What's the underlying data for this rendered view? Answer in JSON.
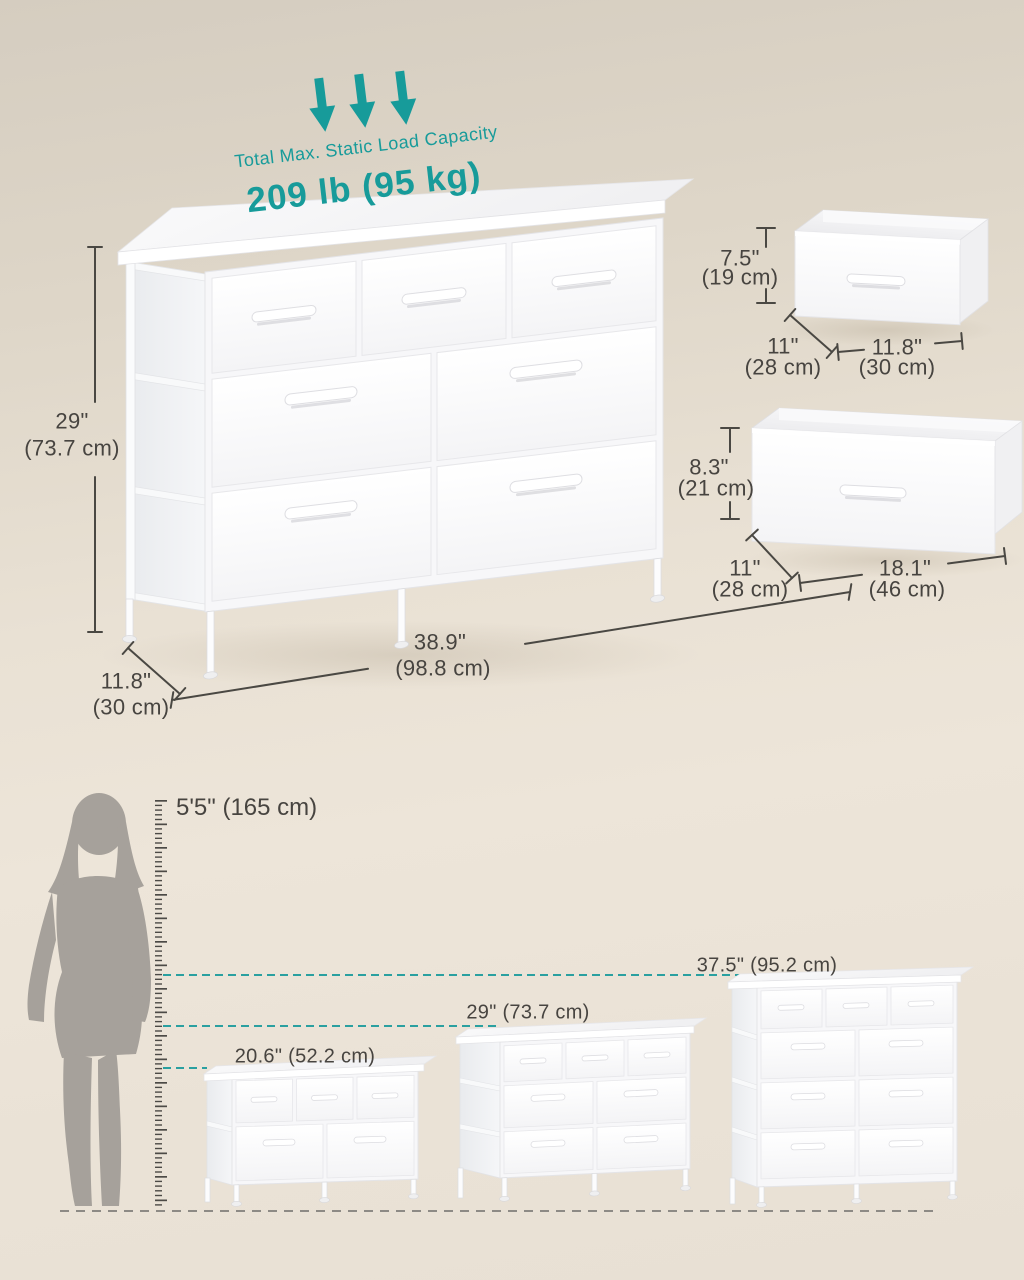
{
  "colors": {
    "teal": "#179b9a",
    "dim_text": "#474440",
    "background_top": "#d5cdc0",
    "background_bottom": "#e8e0d4",
    "furniture_white": "#fdfdfe"
  },
  "load_capacity": {
    "label": "Total Max. Static Load Capacity",
    "value": "209 lb (95 kg)"
  },
  "main_dresser": {
    "height_in": "29\"",
    "height_cm": "(73.7 cm)",
    "depth_in": "11.8\"",
    "depth_cm": "(30 cm)",
    "width_in": "38.9\"",
    "width_cm": "(98.8 cm)"
  },
  "small_drawer_bin": {
    "height_in": "7.5\"",
    "height_cm": "(19 cm)",
    "depth_in": "11\"",
    "depth_cm": "(28 cm)",
    "width_in": "11.8\"",
    "width_cm": "(30 cm)"
  },
  "large_drawer_bin": {
    "height_in": "8.3\"",
    "height_cm": "(21 cm)",
    "depth_in": "11\"",
    "depth_cm": "(28 cm)",
    "width_in": "18.1\"",
    "width_cm": "(46 cm)"
  },
  "comparison": {
    "person_height": "5'5\" (165 cm)",
    "small_dresser_height": "20.6\" (52.2 cm)",
    "medium_dresser_height": "29\" (73.7 cm)",
    "large_dresser_height": "37.5\" (95.2 cm)"
  }
}
